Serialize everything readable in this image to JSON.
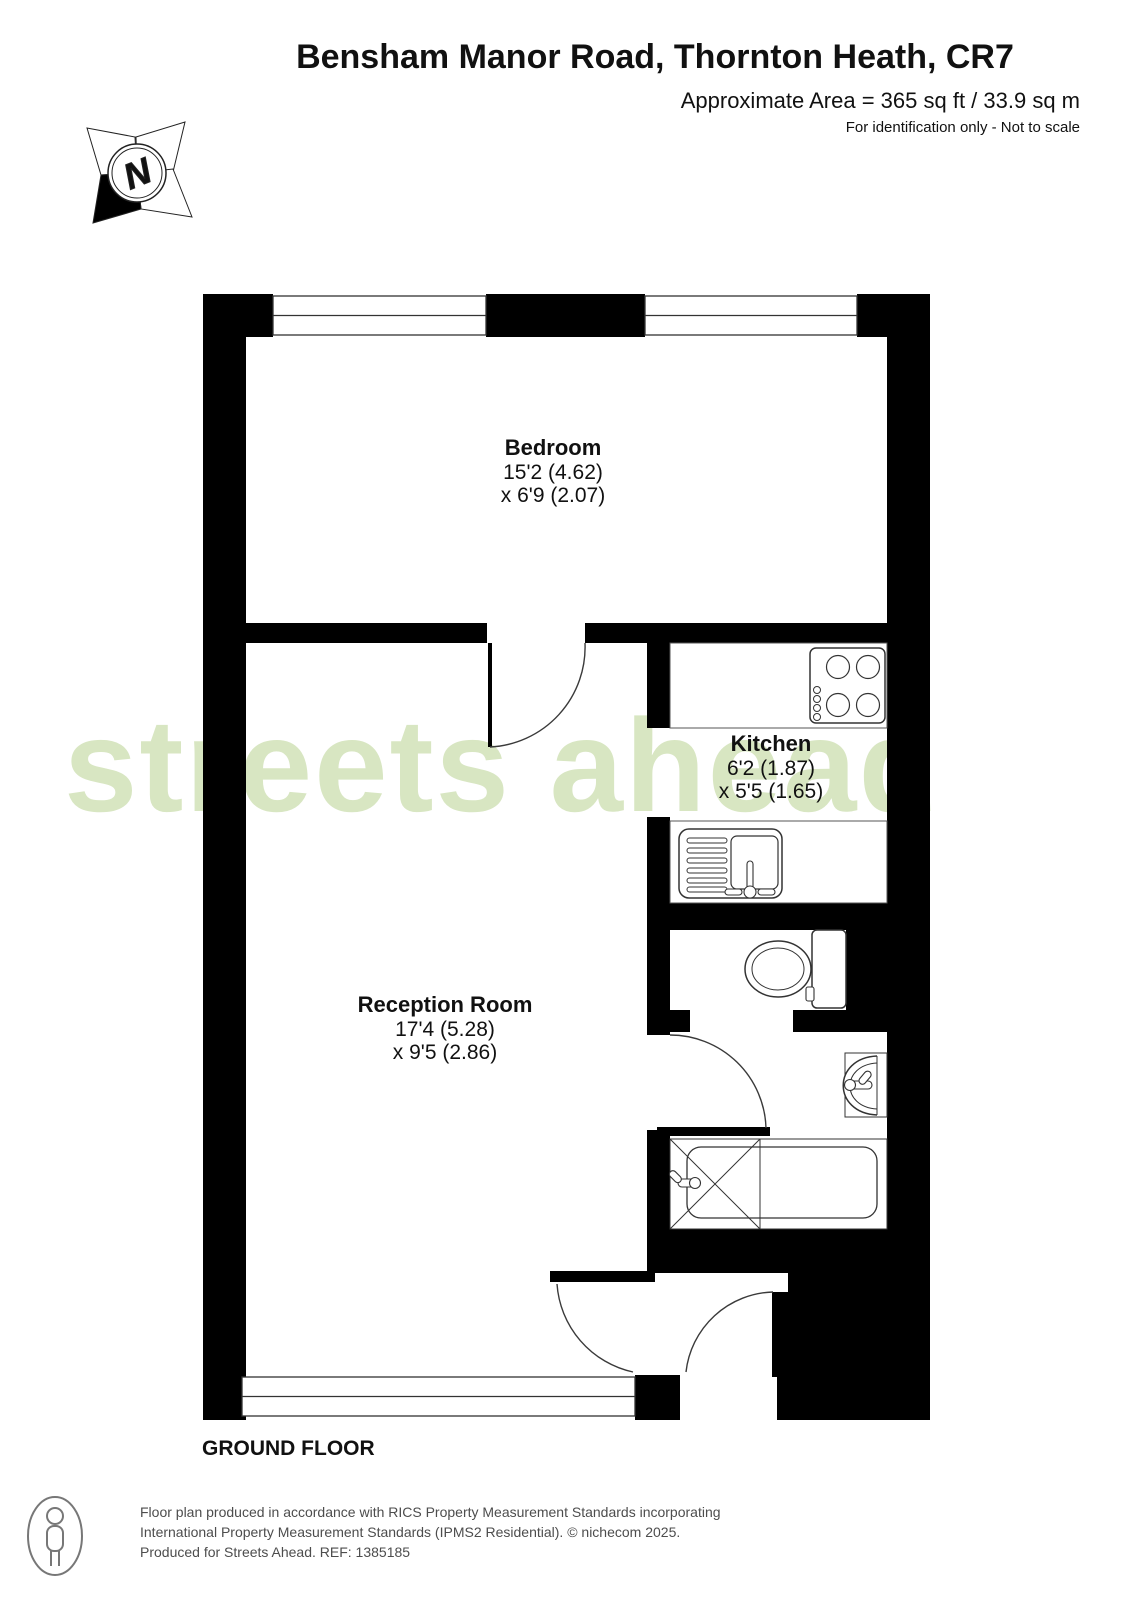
{
  "header": {
    "title": "Bensham Manor Road, Thornton Heath, CR7",
    "area": "Approximate Area = 365 sq ft / 33.9 sq m",
    "disclaimer": "For identification only - Not to scale"
  },
  "compass": {
    "label": "N"
  },
  "watermark": {
    "text": "streets ahead",
    "color": "#d8e6c2"
  },
  "floor": {
    "label": "GROUND FLOOR"
  },
  "rooms": {
    "bedroom": {
      "name": "Bedroom",
      "dim1": "15'2 (4.62)",
      "dim2": "x 6'9 (2.07)"
    },
    "kitchen": {
      "name": "Kitchen",
      "dim1": "6'2 (1.87)",
      "dim2": "x 5'5 (1.65)"
    },
    "reception": {
      "name": "Reception Room",
      "dim1": "17'4 (5.28)",
      "dim2": "x 9'5 (2.86)"
    }
  },
  "footer": {
    "line1": "Floor plan produced in accordance with RICS Property Measurement Standards incorporating",
    "line2": "International Property Measurement Standards (IPMS2 Residential).   © nichecom 2025.",
    "line3": "Produced for Streets Ahead.   REF:  1385185"
  },
  "colors": {
    "wall": "#000000",
    "watermark": "#d8e6c2",
    "fixture_line": "#333333"
  }
}
